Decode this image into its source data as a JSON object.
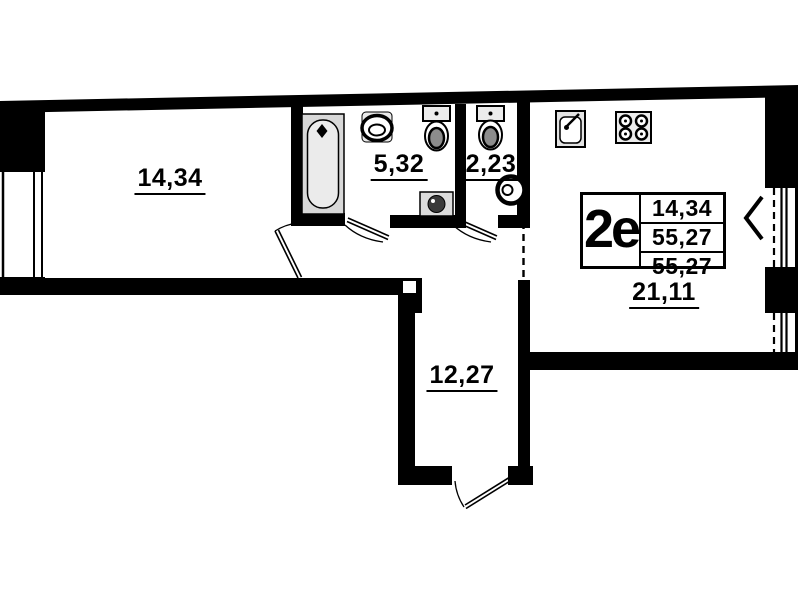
{
  "plan": {
    "colors": {
      "wall": "#000000",
      "background": "#ffffff",
      "fixture_gray": "#e3e3e3",
      "tub_gray": "#d8d8d8"
    },
    "rooms": [
      {
        "name": "room",
        "area_label": "14,34"
      },
      {
        "name": "bathroom",
        "area_label": "5,32"
      },
      {
        "name": "wc",
        "area_label": "2,23"
      },
      {
        "name": "hallway",
        "area_label": "12,27"
      },
      {
        "name": "living-kitchen",
        "area_label": "21,11"
      }
    ],
    "stamp": {
      "unit_type": "2e",
      "rows": [
        "14,34",
        "55,27",
        "55,27"
      ]
    },
    "fixtures": [
      "bathtub-icon",
      "washbasin-icon",
      "toilet-icon",
      "toilet-icon",
      "washing-machine-icon",
      "water-heater-icon",
      "kitchen-sink-icon",
      "stove-icon",
      "balcony-chevron-icon"
    ]
  }
}
